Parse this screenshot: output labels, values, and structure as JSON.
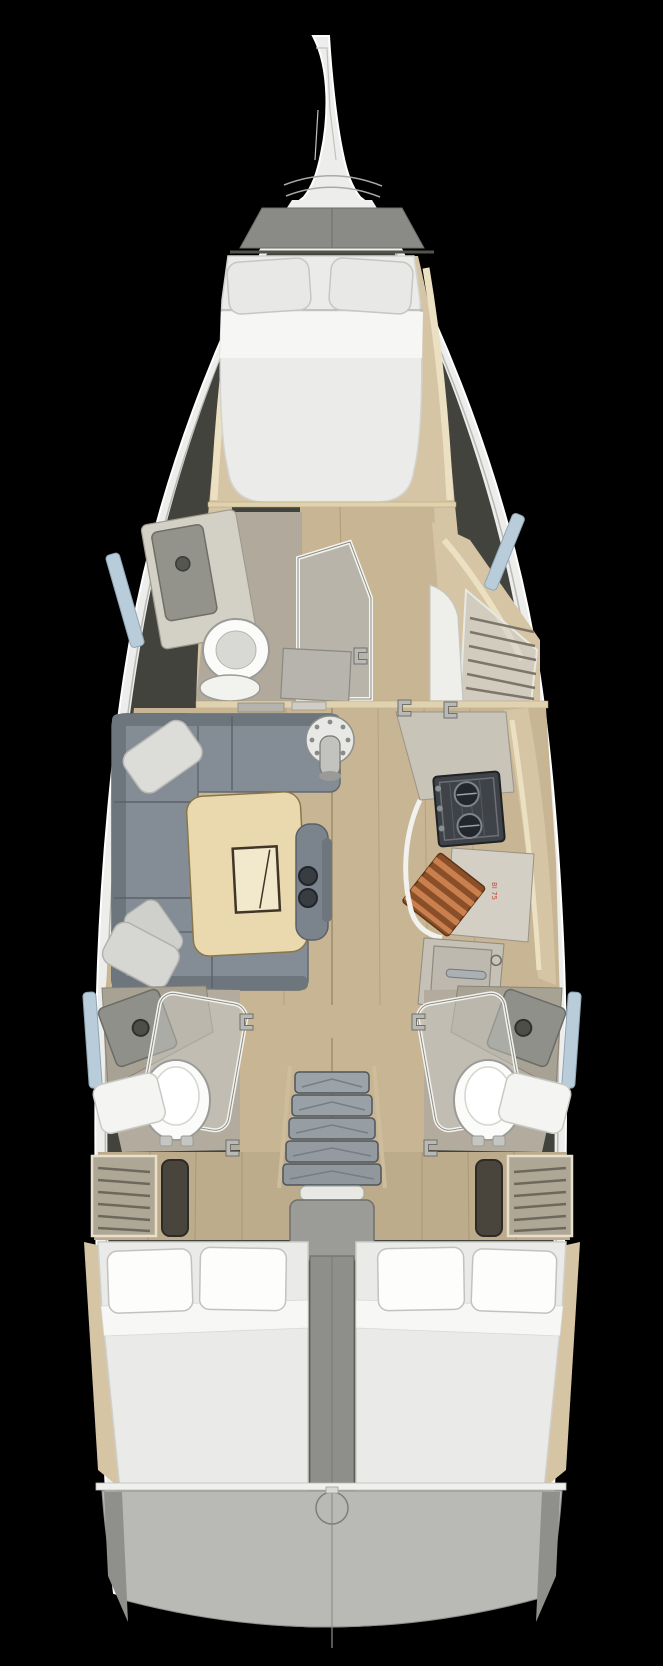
{
  "drawing": {
    "kind": "sailing-yacht interior floor plan, top view, 3-cabin / 3-head layout",
    "background": "#000000"
  },
  "labels": {
    "galley_stamp": "BI 75"
  },
  "palette": {
    "hull_white": "#ededeb",
    "hull_line": "#ffffff",
    "cavity_shadow": "#43433e",
    "floor_wood": "#c8b593",
    "floor_wood_aft": "#bdac8c",
    "plank_line": "#a7916c",
    "trim_wood": "#d6c5a4",
    "bulkhead_trim": "#e0d2ae",
    "bed_linen": "#ebebe9",
    "sheet_white": "#f6f6f4",
    "pillow": "#e8e8e6",
    "sofa": "#848d95",
    "sofa_dark": "#6d757d",
    "table_wood": "#ead9ae",
    "counter": "#c9c4b8",
    "head_floor": "#b1aa9c",
    "stove_body": "#3f4347",
    "glass": "#d7d7d2",
    "window_blue": "#b9ccd9",
    "stairs_gray": "#9ba3a9",
    "engine_gray": "#8e8e8a",
    "transom_gray": "#b9bab6",
    "porcelain": "#fbfbf9",
    "chrome": "#aab0b4",
    "cutting_board_copper": "#8a4f28",
    "cutting_board_stripe": "#c9804e",
    "stamp_red": "#c0392b"
  },
  "inventory": {
    "bow": [
      "bowsprit",
      "anchor-locker",
      "foredeck"
    ],
    "forward_cabin": {
      "bed": "v-berth-double",
      "pillows": 2,
      "side_shelves": 2
    },
    "forward_head": [
      "counter-sink",
      "toilet",
      "shower-enclosure",
      "hull-window",
      "open-door"
    ],
    "starboard_forward": [
      "wardrobe-shelf-locker"
    ],
    "salon": {
      "sofa": "u-shaped",
      "pillows": 3,
      "table": "folding-leaf-table",
      "seat": "bench-with-cupholders",
      "cupholders": 2,
      "mast_post": 1
    },
    "galley": [
      "counter",
      "two-burner-stove",
      "cutting-board",
      "sink-cabinet",
      "faucet",
      "hull-shelf"
    ],
    "aft_head_port": [
      "counter-sink",
      "toilet",
      "shower-door",
      "bath-mat",
      "hull-window"
    ],
    "aft_head_starboard": [
      "counter-sink",
      "toilet",
      "shower-door",
      "bath-mat",
      "hull-window"
    ],
    "companionway": {
      "stair_treads": 5,
      "rails": 2,
      "threshold": 1
    },
    "aft_cabin_port": {
      "bed": "double",
      "pillows": 2,
      "vent_locker": 1,
      "recess": 1
    },
    "aft_cabin_starboard": {
      "bed": "double",
      "pillows": 2,
      "vent_locker": 1,
      "recess": 1
    },
    "stern": [
      "engine-trunk",
      "center-spine",
      "transom-platform",
      "steering-access-circle"
    ]
  }
}
